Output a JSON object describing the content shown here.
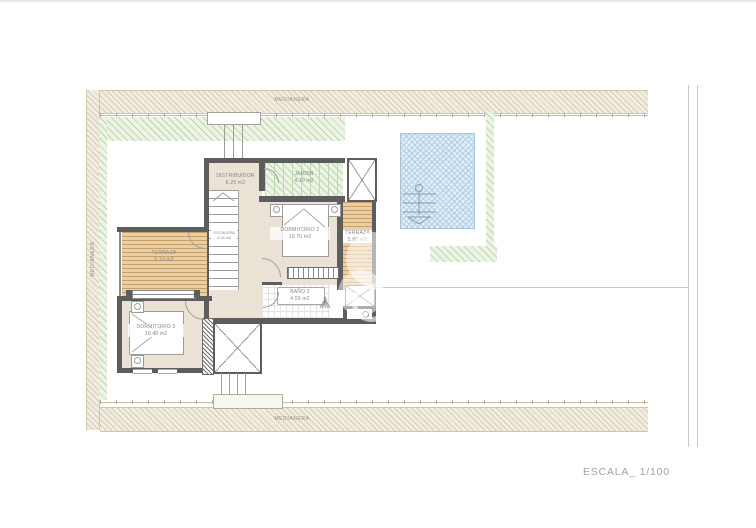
{
  "drawing": {
    "scale_label": "ESCALA_ 1/100"
  },
  "boundaries": {
    "top_label": "MEDIANERA",
    "bottom_label": "MEDIANERA",
    "left_label": "MEDIANERA"
  },
  "rooms": {
    "distribuidor": {
      "name": "DISTRIBUIDOR",
      "area": "8.20 m2"
    },
    "jardin": {
      "name": "JARDÍN",
      "area": "4.10 m2"
    },
    "dormitorio2": {
      "name": "DORMITORIO 2",
      "area": "10.70 m2"
    },
    "terraza_right": {
      "name": "TERRAZA",
      "area": "5.80 m2"
    },
    "escalera": {
      "name": "ESCALERA",
      "area": "4.15 m2"
    },
    "terraza_left": {
      "name": "TERRAZA",
      "area": "9.10 m2"
    },
    "dormitorio3": {
      "name": "DORMITORIO 3",
      "area": "10.40 m2"
    },
    "bano2": {
      "name": "BAÑO 2",
      "area": "4.55 m2"
    }
  },
  "colors": {
    "wall": "#5d5d5d",
    "floor": "#eae2d4",
    "deck-bg": "#e8cfa5",
    "deck-line": "#c6a066",
    "green-bg": "#edf4e6",
    "green-line": "#bcd8ae",
    "pool-bg": "#dfeef8",
    "pool-line": "#b3cee2",
    "med-bg": "#f2ede1",
    "med-line": "#d8cdb6"
  }
}
